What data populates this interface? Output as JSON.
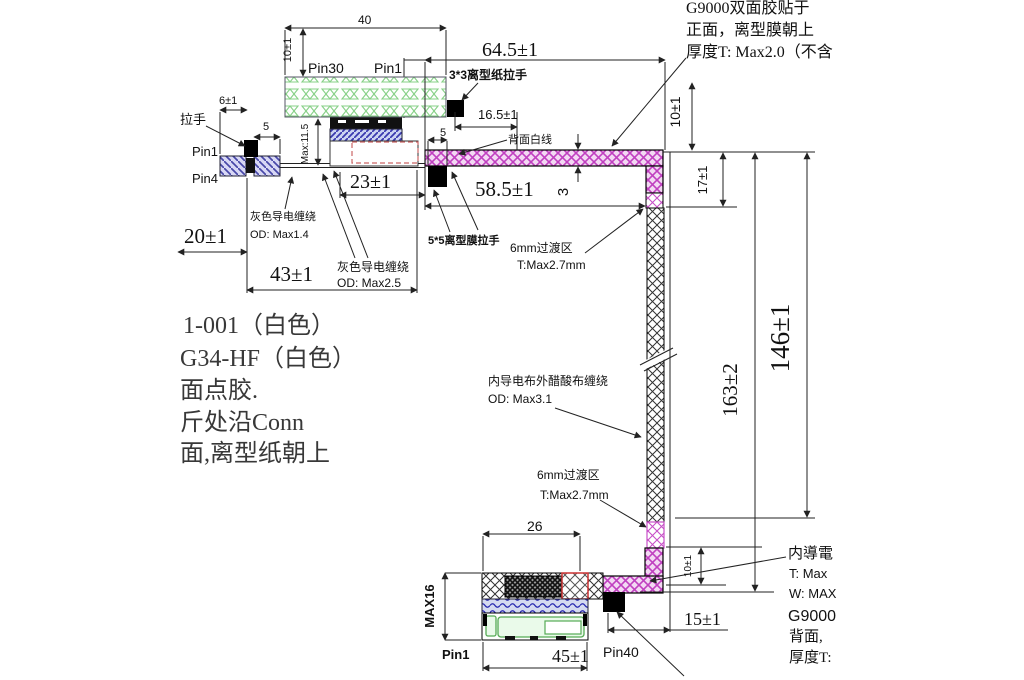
{
  "drawing_title": "FFC cable assembly engineering drawing",
  "dims": {
    "top_width": "40",
    "top_gap": "10±1",
    "arm_length": "64.5±1",
    "seg_165": "16.5±1",
    "tab_5_top": "5",
    "d23": "23±1",
    "d585": "58.5±1",
    "strip_thickness": "3",
    "d10_right": "10±1",
    "d17": "17±1",
    "d6": "6±1",
    "d5_left": "5",
    "max115": "Max:11.5",
    "d20": "20±1",
    "d43": "43±1",
    "d163": "163±2",
    "d146": "146±1",
    "d26": "26",
    "max16": "MAX16",
    "d45": "45±1",
    "d15": "15±1",
    "d10_bottom": "10±1"
  },
  "pins": {
    "pin30": "Pin30",
    "pin1_top": "Pin1",
    "pin1_left": "Pin1",
    "pin4_left": "Pin4",
    "pin1_bottom": "Pin1",
    "pin40": "Pin40"
  },
  "callouts": {
    "tab33": "3*3离型纸拉手",
    "back_white_line": "背面白线",
    "pull_tab": "拉手",
    "gray_wrap_1": [
      "灰色导电缠绕",
      "OD: Max1.4"
    ],
    "gray_wrap_2": [
      "灰色导电缠绕",
      "OD: Max2.5"
    ],
    "tab55": "5*5离型膜拉手",
    "transition_1": [
      "6mm过渡区",
      "T:Max2.7mm"
    ],
    "acetate_wrap": [
      "内导电布外醋酸布缠绕",
      "OD: Max3.1"
    ],
    "transition_2": [
      "6mm过渡区",
      "T:Max2.7mm"
    ]
  },
  "notes_top_right": [
    "G9000双面胶贴于",
    "正面，离型膜朝上",
    "厚度T: Max2.0（不含"
  ],
  "notes_left": [
    "1-001（白色）",
    "G34-HF（白色）",
    "面点胶.",
    "斤处沿Conn",
    "面,离型纸朝上"
  ],
  "notes_bottom_right": [
    "内導電",
    "T: Max",
    "W: MAX",
    "G9000",
    "背面,",
    "厚度T:"
  ],
  "colors": {
    "magenta_tape": "#c040c0",
    "green_stiffener": "#86d086",
    "blue_hatch": "#3a3ab0",
    "red_section": "#cc3333"
  }
}
